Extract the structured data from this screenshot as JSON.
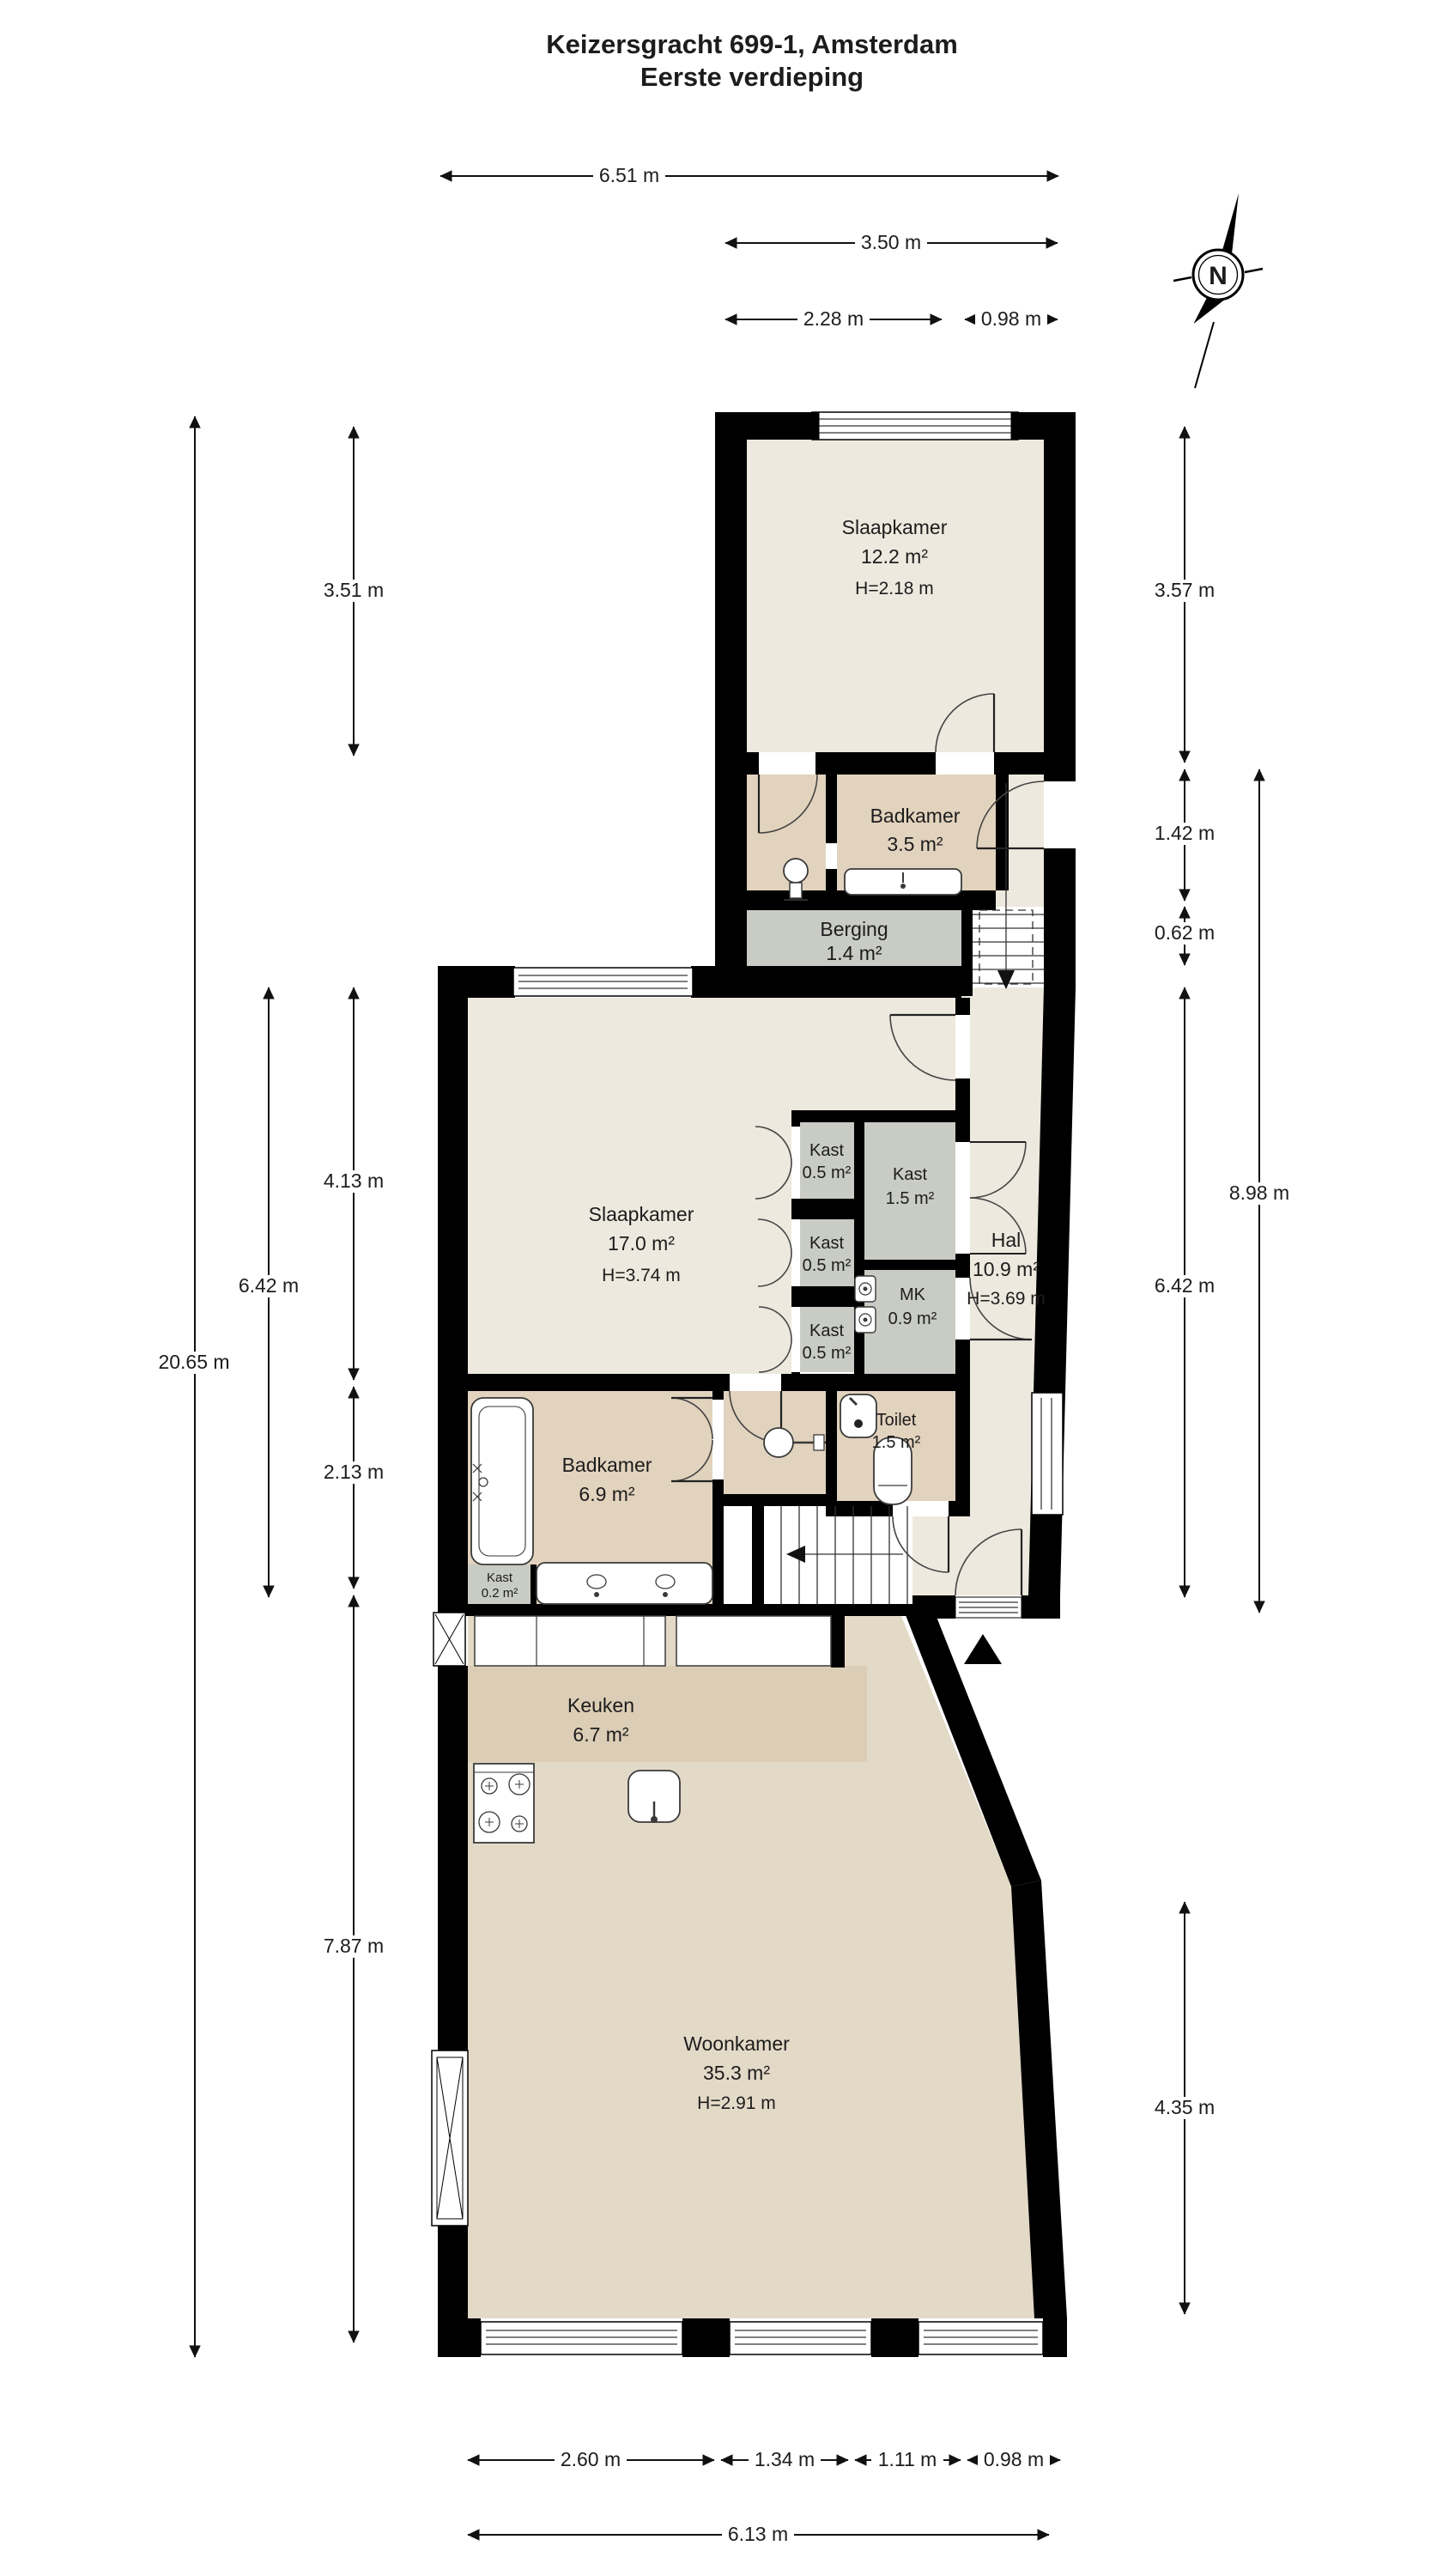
{
  "title": {
    "line1": "Keizersgracht 699-1, Amsterdam",
    "line2": "Eerste verdieping"
  },
  "compass": {
    "label": "N"
  },
  "rooms": [
    {
      "id": "slaapkamer-boven",
      "name": "Slaapkamer",
      "area": "12.2 m²",
      "height": "H=2.18 m"
    },
    {
      "id": "badkamer-boven",
      "name": "Badkamer",
      "area": "3.5 m²"
    },
    {
      "id": "berging",
      "name": "Berging",
      "area": "1.4 m²"
    },
    {
      "id": "slaapkamer",
      "name": "Slaapkamer",
      "area": "17.0 m²",
      "height": "H=3.74 m"
    },
    {
      "id": "kast-1",
      "name": "Kast",
      "area": "0.5 m²"
    },
    {
      "id": "kast-2",
      "name": "Kast",
      "area": "0.5 m²"
    },
    {
      "id": "kast-3",
      "name": "Kast",
      "area": "0.5 m²"
    },
    {
      "id": "kast-groot",
      "name": "Kast",
      "area": "1.5 m²"
    },
    {
      "id": "mk",
      "name": "MK",
      "area": "0.9 m²"
    },
    {
      "id": "hal",
      "name": "Hal",
      "area": "10.9 m²",
      "height": "H=3.69 m"
    },
    {
      "id": "toilet",
      "name": "Toilet",
      "area": "1.5 m²"
    },
    {
      "id": "badkamer",
      "name": "Badkamer",
      "area": "6.9 m²"
    },
    {
      "id": "kast-klein",
      "name": "Kast",
      "area": "0.2 m²"
    },
    {
      "id": "keuken",
      "name": "Keuken",
      "area": "6.7 m²"
    },
    {
      "id": "woonkamer",
      "name": "Woonkamer",
      "area": "35.3 m²",
      "height": "H=2.91 m"
    }
  ],
  "dimensions": {
    "top": [
      {
        "label": "6.51 m"
      },
      {
        "label": "3.50 m"
      },
      {
        "label": "2.28 m"
      },
      {
        "label": "0.98 m"
      }
    ],
    "bottom": [
      {
        "label": "2.60 m"
      },
      {
        "label": "1.34 m"
      },
      {
        "label": "1.11 m"
      },
      {
        "label": "0.98 m"
      },
      {
        "label": "6.13 m"
      }
    ],
    "left": [
      {
        "label": "3.51 m"
      },
      {
        "label": "4.13 m"
      },
      {
        "label": "2.13 m"
      },
      {
        "label": "7.87 m"
      },
      {
        "label": "6.42 m"
      },
      {
        "label": "20.65 m"
      }
    ],
    "right": [
      {
        "label": "3.57 m"
      },
      {
        "label": "1.42 m"
      },
      {
        "label": "0.62 m"
      },
      {
        "label": "8.98 m"
      },
      {
        "label": "6.42 m"
      },
      {
        "label": "4.35 m"
      }
    ]
  },
  "colors": {
    "wall": "#000000",
    "floor_light": "#EDE9DE",
    "floor_tan": "#E2D3BE",
    "floor_gray": "#C9CCC4",
    "floor_kitchen": "#DCCDB6",
    "floor_living": "#E3D9C7"
  }
}
